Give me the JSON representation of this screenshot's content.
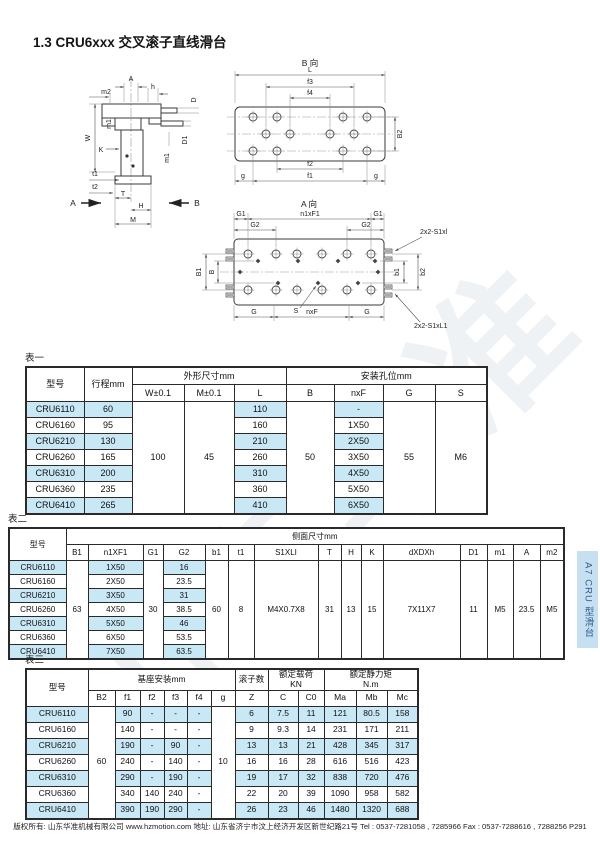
{
  "page": {
    "title": "1.3 CRU6xxx 交叉滚子直线滑台",
    "side_tab": "A7 CRU 型滑台",
    "watermark": "山东华准",
    "footer": "版权所有: 山东华准机械有限公司 www.hzmotion.com 地址: 山东省济宁市汶上经济开发区新世纪路21号 Tel : 0537-7281058 , 7285966 Fax : 0537-7288616 , 7288256  P291"
  },
  "drawings": {
    "section": {
      "a": "A",
      "m2": "m2",
      "h": "h",
      "w": "W",
      "m1l": "m1",
      "k": "K",
      "t1": "t1",
      "t2": "t2",
      "t": "T",
      "hh": "H",
      "m": "M",
      "d": "D",
      "d1": "D1",
      "m1r": "m1",
      "va": "A",
      "vb": "B"
    },
    "viewb": {
      "title": "B 向",
      "l": "L",
      "f3": "f3",
      "f4": "f4",
      "b2": "B2",
      "f2": "f2",
      "f1": "f1",
      "gl": "g",
      "gr": "g"
    },
    "viewa": {
      "title": "A 向",
      "g1l": "G1",
      "n1xf1": "n1xF1",
      "g1r": "G1",
      "g2l": "G2",
      "g2r": "G2",
      "b1": "B1",
      "b": "B",
      "rb1": "b1",
      "rb2": "b2",
      "s1": "2x2-S1xl",
      "s2": "2x2-S1xL1",
      "gbl": "G",
      "nxf": "nxF",
      "gbr": "G",
      "s": "S"
    }
  },
  "tables": {
    "t1": {
      "label": "表一",
      "width": 461,
      "cols": [
        58,
        48,
        52,
        50,
        52,
        48,
        49,
        52,
        52
      ],
      "header": [
        [
          {
            "t": "型号",
            "rs": 2
          },
          {
            "t": "行程mm",
            "rs": 2
          },
          {
            "t": "外形尺寸mm",
            "cs": 3
          },
          {
            "t": "安装孔位mm",
            "cs": 4
          }
        ],
        [
          {
            "t": "W±0.1"
          },
          {
            "t": "M±0.1"
          },
          {
            "t": "L"
          },
          {
            "t": "B"
          },
          {
            "t": "nxF"
          },
          {
            "t": "G"
          },
          {
            "t": "S"
          }
        ]
      ],
      "rows": [
        [
          {
            "t": "CRU6110",
            "hl": 1
          },
          {
            "t": "60",
            "hl": 1
          },
          {
            "t": "100",
            "rs": 7
          },
          {
            "t": "45",
            "rs": 7
          },
          {
            "t": "110",
            "hl": 1
          },
          {
            "t": "50",
            "rs": 7
          },
          {
            "t": "-",
            "hl": 1
          },
          {
            "t": "55",
            "rs": 7
          },
          {
            "t": "M6",
            "rs": 7
          }
        ],
        [
          {
            "t": "CRU6160"
          },
          {
            "t": "95"
          },
          {
            "t": "160"
          },
          {
            "t": "1X50"
          }
        ],
        [
          {
            "t": "CRU6210",
            "hl": 1
          },
          {
            "t": "130",
            "hl": 1
          },
          {
            "t": "210",
            "hl": 1
          },
          {
            "t": "2X50",
            "hl": 1
          }
        ],
        [
          {
            "t": "CRU6260"
          },
          {
            "t": "165"
          },
          {
            "t": "260"
          },
          {
            "t": "3X50"
          }
        ],
        [
          {
            "t": "CRU6310",
            "hl": 1
          },
          {
            "t": "200",
            "hl": 1
          },
          {
            "t": "310",
            "hl": 1
          },
          {
            "t": "4X50",
            "hl": 1
          }
        ],
        [
          {
            "t": "CRU6360"
          },
          {
            "t": "235"
          },
          {
            "t": "360"
          },
          {
            "t": "5X50"
          }
        ],
        [
          {
            "t": "CRU6410",
            "hl": 1
          },
          {
            "t": "265",
            "hl": 1
          },
          {
            "t": "410",
            "hl": 1
          },
          {
            "t": "6X50",
            "hl": 1
          }
        ]
      ]
    },
    "t2": {
      "label": "表二",
      "width": 555,
      "cols": [
        57,
        22,
        55,
        20,
        42,
        23,
        26,
        64,
        23,
        20,
        22,
        77,
        27,
        26,
        27,
        24
      ],
      "header": [
        [
          {
            "t": "型号",
            "rs": 2
          },
          {
            "t": "侧面尺寸mm",
            "cs": 15
          }
        ],
        [
          {
            "t": "B1"
          },
          {
            "t": "n1XF1"
          },
          {
            "t": "G1"
          },
          {
            "t": "G2"
          },
          {
            "t": "b1"
          },
          {
            "t": "t1"
          },
          {
            "t": "S1XLI"
          },
          {
            "t": "T"
          },
          {
            "t": "H"
          },
          {
            "t": "K"
          },
          {
            "t": "dXDXh"
          },
          {
            "t": "D1"
          },
          {
            "t": "m1"
          },
          {
            "t": "A"
          },
          {
            "t": "m2"
          }
        ]
      ],
      "rows": [
        [
          {
            "t": "CRU6110",
            "hl": 1
          },
          {
            "t": "63",
            "rs": 7
          },
          {
            "t": "1X50",
            "hl": 1
          },
          {
            "t": "30",
            "rs": 7
          },
          {
            "t": "16",
            "hl": 1
          },
          {
            "t": "60",
            "rs": 7
          },
          {
            "t": "8",
            "rs": 7
          },
          {
            "t": "M4X0.7X8",
            "rs": 7
          },
          {
            "t": "31",
            "rs": 7
          },
          {
            "t": "13",
            "rs": 7
          },
          {
            "t": "15",
            "rs": 7
          },
          {
            "t": "7X11X7",
            "rs": 7
          },
          {
            "t": "11",
            "rs": 7
          },
          {
            "t": "M5",
            "rs": 7
          },
          {
            "t": "23.5",
            "rs": 7
          },
          {
            "t": "M5",
            "rs": 7
          }
        ],
        [
          {
            "t": "CRU6160"
          },
          {
            "t": "2X50"
          },
          {
            "t": "23.5"
          }
        ],
        [
          {
            "t": "CRU6210",
            "hl": 1
          },
          {
            "t": "3X50",
            "hl": 1
          },
          {
            "t": "31",
            "hl": 1
          }
        ],
        [
          {
            "t": "CRU6260"
          },
          {
            "t": "4X50"
          },
          {
            "t": "38.5"
          }
        ],
        [
          {
            "t": "CRU6310",
            "hl": 1
          },
          {
            "t": "5X50",
            "hl": 1
          },
          {
            "t": "46",
            "hl": 1
          }
        ],
        [
          {
            "t": "CRU6360"
          },
          {
            "t": "6X50"
          },
          {
            "t": "53.5"
          }
        ],
        [
          {
            "t": "CRU6410",
            "hl": 1
          },
          {
            "t": "7X50",
            "hl": 1
          },
          {
            "t": "63.5",
            "hl": 1
          }
        ]
      ]
    },
    "t3": {
      "label": "表三",
      "width": 392,
      "cols": [
        62,
        27,
        25,
        24,
        23,
        24,
        24,
        33,
        30,
        26,
        32,
        31,
        31
      ],
      "header": [
        [
          {
            "t": "型号",
            "rs": 2
          },
          {
            "t": "基座安装mm",
            "cs": 6
          },
          {
            "t": "滚子数"
          },
          {
            "t": "额定载荷\nKN",
            "cs": 2
          },
          {
            "t": "额定静力矩\nN.m",
            "cs": 3
          }
        ],
        [
          {
            "t": "B2"
          },
          {
            "t": "f1"
          },
          {
            "t": "f2"
          },
          {
            "t": "f3"
          },
          {
            "t": "f4"
          },
          {
            "t": "g"
          },
          {
            "t": "Z"
          },
          {
            "t": "C"
          },
          {
            "t": "C0"
          },
          {
            "t": "Ma"
          },
          {
            "t": "Mb"
          },
          {
            "t": "Mc"
          }
        ]
      ],
      "rows": [
        [
          {
            "t": "CRU6110",
            "hl": 1
          },
          {
            "t": "60",
            "rs": 7
          },
          {
            "t": "90",
            "hl": 1
          },
          {
            "t": "-",
            "hl": 1
          },
          {
            "t": "-",
            "hl": 1
          },
          {
            "t": "-",
            "hl": 1
          },
          {
            "t": "10",
            "rs": 7
          },
          {
            "t": "6",
            "hl": 1
          },
          {
            "t": "7.5",
            "hl": 1
          },
          {
            "t": "11",
            "hl": 1
          },
          {
            "t": "121",
            "hl": 1
          },
          {
            "t": "80.5",
            "hl": 1
          },
          {
            "t": "158",
            "hl": 1
          }
        ],
        [
          {
            "t": "CRU6160"
          },
          {
            "t": "140"
          },
          {
            "t": "-"
          },
          {
            "t": "-"
          },
          {
            "t": "-"
          },
          {
            "t": "9"
          },
          {
            "t": "9.3"
          },
          {
            "t": "14"
          },
          {
            "t": "231"
          },
          {
            "t": "171"
          },
          {
            "t": "211"
          }
        ],
        [
          {
            "t": "CRU6210",
            "hl": 1
          },
          {
            "t": "190",
            "hl": 1
          },
          {
            "t": "-",
            "hl": 1
          },
          {
            "t": "90",
            "hl": 1
          },
          {
            "t": "-",
            "hl": 1
          },
          {
            "t": "13",
            "hl": 1
          },
          {
            "t": "13",
            "hl": 1
          },
          {
            "t": "21",
            "hl": 1
          },
          {
            "t": "428",
            "hl": 1
          },
          {
            "t": "345",
            "hl": 1
          },
          {
            "t": "317",
            "hl": 1
          }
        ],
        [
          {
            "t": "CRU6260"
          },
          {
            "t": "240"
          },
          {
            "t": "-"
          },
          {
            "t": "140"
          },
          {
            "t": "-"
          },
          {
            "t": "16"
          },
          {
            "t": "16"
          },
          {
            "t": "28"
          },
          {
            "t": "616"
          },
          {
            "t": "516"
          },
          {
            "t": "423"
          }
        ],
        [
          {
            "t": "CRU6310",
            "hl": 1
          },
          {
            "t": "290",
            "hl": 1
          },
          {
            "t": "-",
            "hl": 1
          },
          {
            "t": "190",
            "hl": 1
          },
          {
            "t": "-",
            "hl": 1
          },
          {
            "t": "19",
            "hl": 1
          },
          {
            "t": "17",
            "hl": 1
          },
          {
            "t": "32",
            "hl": 1
          },
          {
            "t": "838",
            "hl": 1
          },
          {
            "t": "720",
            "hl": 1
          },
          {
            "t": "476",
            "hl": 1
          }
        ],
        [
          {
            "t": "CRU6360"
          },
          {
            "t": "340"
          },
          {
            "t": "140"
          },
          {
            "t": "240"
          },
          {
            "t": "-"
          },
          {
            "t": "22"
          },
          {
            "t": "20"
          },
          {
            "t": "39"
          },
          {
            "t": "1090"
          },
          {
            "t": "958"
          },
          {
            "t": "582"
          }
        ],
        [
          {
            "t": "CRU6410",
            "hl": 1
          },
          {
            "t": "390",
            "hl": 1
          },
          {
            "t": "190",
            "hl": 1
          },
          {
            "t": "290",
            "hl": 1
          },
          {
            "t": "-",
            "hl": 1
          },
          {
            "t": "26",
            "hl": 1
          },
          {
            "t": "23",
            "hl": 1
          },
          {
            "t": "46",
            "hl": 1
          },
          {
            "t": "1480",
            "hl": 1
          },
          {
            "t": "1320",
            "hl": 1
          },
          {
            "t": "688",
            "hl": 1
          }
        ]
      ]
    }
  }
}
